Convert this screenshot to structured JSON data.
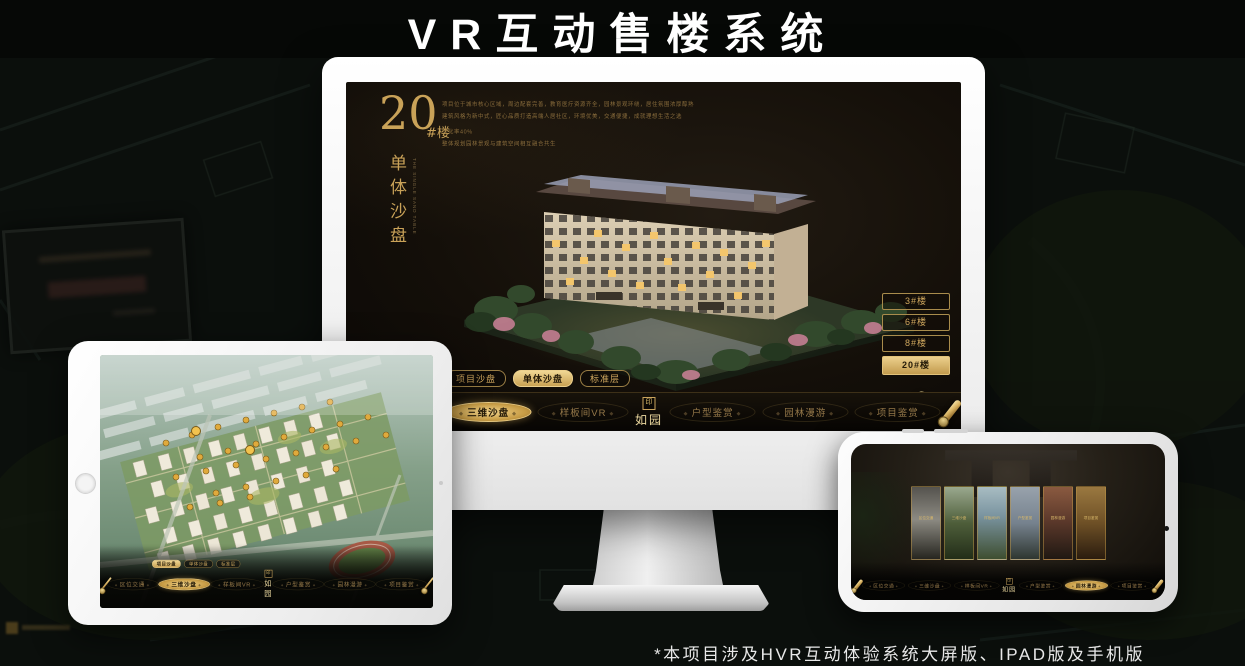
{
  "page": {
    "title": "VR互动售楼系统",
    "footnote": "*本项目涉及HVR互动体验系统大屏版、IPAD版及手机版"
  },
  "colors": {
    "gold": "#d0a75c",
    "gold_dim": "#8a7448",
    "screen_bg": "#15100a",
    "selected_text": "#241a08"
  },
  "logo": {
    "text": "如园",
    "seal": "印"
  },
  "subtabs": [
    "项目沙盘",
    "单体沙盘",
    "标准层"
  ],
  "nav_items": [
    "区位交通",
    "三维沙盘",
    "样板间VR",
    "户型鉴赏",
    "园林漫游",
    "项目鉴赏"
  ],
  "monitor": {
    "block_number": "20",
    "block_suffix": "#楼",
    "block_subtitle": "单体沙盘",
    "block_subtitle_en": "THE SINGLE SAND TABLE",
    "description_lines": [
      "项目位于城市核心区域，周边配套完善，教育医疗资源齐全，园林景观环绕，居住氛围浓厚醇熟",
      "建筑风格为新中式，匠心品质打造高端人居社区，环境优美，交通便捷，成就理想生活之选",
      "绿化率40%",
      "整体规划园林景观与建筑空间相互融合共生"
    ],
    "floor_buttons": [
      "3#楼",
      "6#楼",
      "8#楼",
      "20#楼"
    ],
    "floor_selected_index": 3,
    "subtab_selected_index": 1,
    "nav_selected_index": 1
  },
  "ipad": {
    "subtab_selected_index": 0,
    "nav_selected_index": 1
  },
  "phone": {
    "nav_selected_index": 4,
    "cards": [
      "区位交通",
      "三维沙盘",
      "样板间VR",
      "户型鉴赏",
      "园林漫游",
      "项目鉴赏"
    ]
  }
}
